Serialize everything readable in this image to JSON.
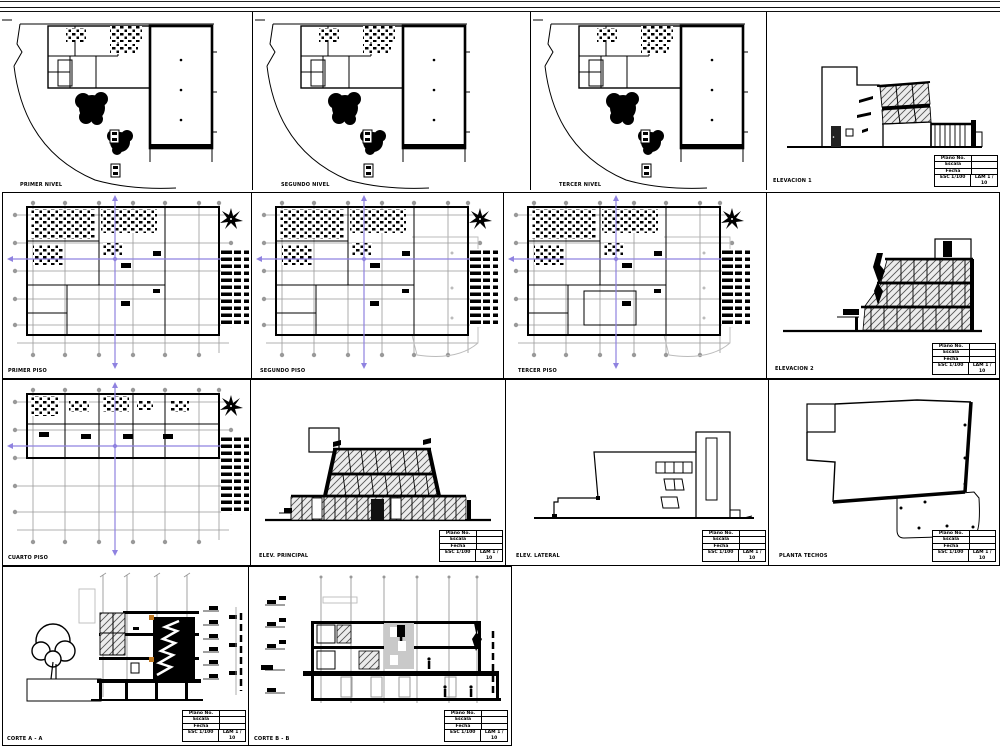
{
  "palette": {
    "paper": "#ffffff",
    "ink": "#000000",
    "grid": "#999999",
    "ghost": "#bbbbbb",
    "section": "#8f82e0",
    "accent": "#c07820",
    "glass": "#ececec"
  },
  "labels": {
    "site1": "PRIMER NIVEL",
    "site2": "SEGUNDO NIVEL",
    "site3": "TERCER NIVEL",
    "elev1": "ELEVACION 1",
    "plan1": "PRIMER PISO",
    "plan2": "SEGUNDO PISO",
    "plan3": "TERCER PISO",
    "elev2": "ELEVACION 2",
    "plan4": "CUARTO PISO",
    "elev3": "ELEV. PRINCIPAL",
    "elev4": "ELEV. LATERAL",
    "roof": "PLANTA TECHOS",
    "sectionA": "CORTE A - A",
    "sectionB": "CORTE B - B"
  },
  "titleblock": {
    "f1": "Plano No.",
    "f2": "Escala",
    "f3": "Fecha",
    "esc": "ESC 1/100",
    "lam": "LAM 1 / 10"
  }
}
